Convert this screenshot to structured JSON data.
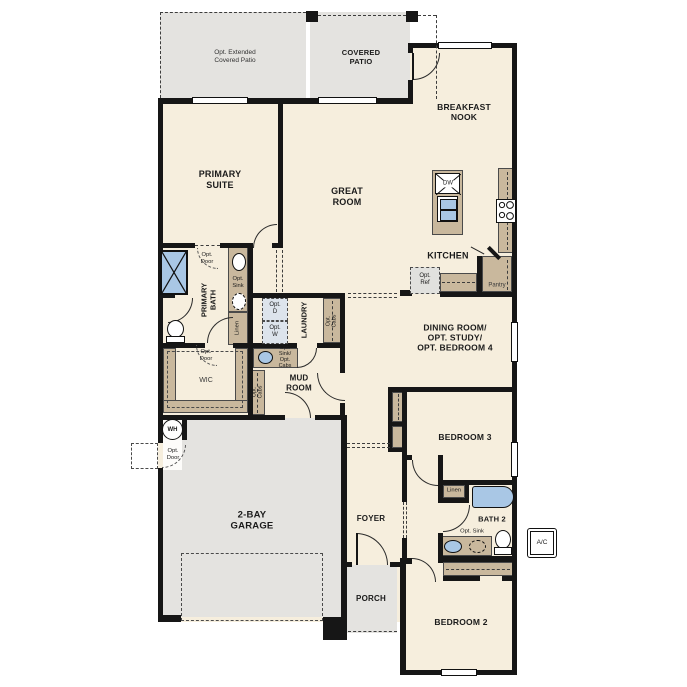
{
  "colors": {
    "floor": "#f6eedd",
    "outdoor": "#e4e3e0",
    "cabinet": "#c9b89d",
    "fixture_blue": "#a9c7e5",
    "wall": "#161616",
    "optional_fill": "#dde4ec"
  },
  "rooms": {
    "primary_suite": "PRIMARY\nSUITE",
    "great_room": "GREAT\nROOM",
    "breakfast_nook": "BREAKFAST\nNOOK",
    "covered_patio": "COVERED\nPATIO",
    "opt_ext_patio": "Opt. Extended\nCovered Patio",
    "kitchen": "KITCHEN",
    "pantry": "Pantry",
    "dining": "DINING ROOM/\nOPT. STUDY/\nOPT. BEDROOM 4",
    "laundry": "LAUNDRY",
    "mud_room": "MUD\nROOM",
    "wic": "WIC",
    "primary_bath": "PRIMARY\nBATH",
    "foyer": "FOYER",
    "porch": "PORCH",
    "garage": "2-BAY\nGARAGE",
    "bedroom2": "BEDROOM 2",
    "bedroom3": "BEDROOM 3",
    "bath2": "BATH 2"
  },
  "fixtures": {
    "dw": "DW",
    "wh": "WH",
    "ac": "A/C",
    "linen": "Linen"
  },
  "options": {
    "opt_door": "Opt.\nDoor",
    "opt_sink": "Opt.\nSink",
    "opt_sink_inline": "Opt. Sink",
    "opt_ref": "Opt.\nRef",
    "opt_d": "Opt.\nD",
    "opt_w": "Opt.\nW",
    "opt_cabs": "Opt.\nCabs",
    "opt_sink_cabs": "Opt.\nSink/\nOpt.\nCabs"
  }
}
